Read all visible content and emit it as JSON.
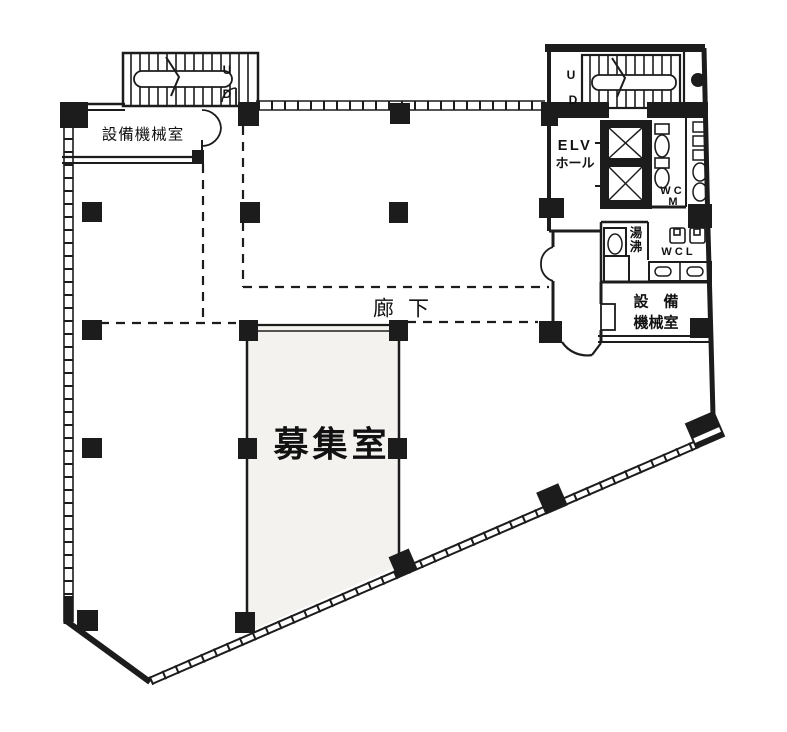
{
  "colors": {
    "line": "#1c1c1c",
    "background": "#ffffff",
    "recruit_fill": "#f3f2ee"
  },
  "labels": {
    "equipment_room_top_left": "設備機械室",
    "stair_top_left_up": "U",
    "stair_top_left_down": "D",
    "stair_top_right_up": "U",
    "stair_top_right_down": "D",
    "elv_hall_line1": "ELV",
    "elv_hall_line2": "ホール",
    "wc_men_line1": "W C",
    "wc_men_line2": "M",
    "hot_water_char1": "湯",
    "hot_water_char2": "沸",
    "wc_ladies": "W C L",
    "equipment_room_right_line1": "設　備",
    "equipment_room_right_line2": "機械室",
    "corridor": "廊下",
    "recruit_room": "募集室"
  }
}
